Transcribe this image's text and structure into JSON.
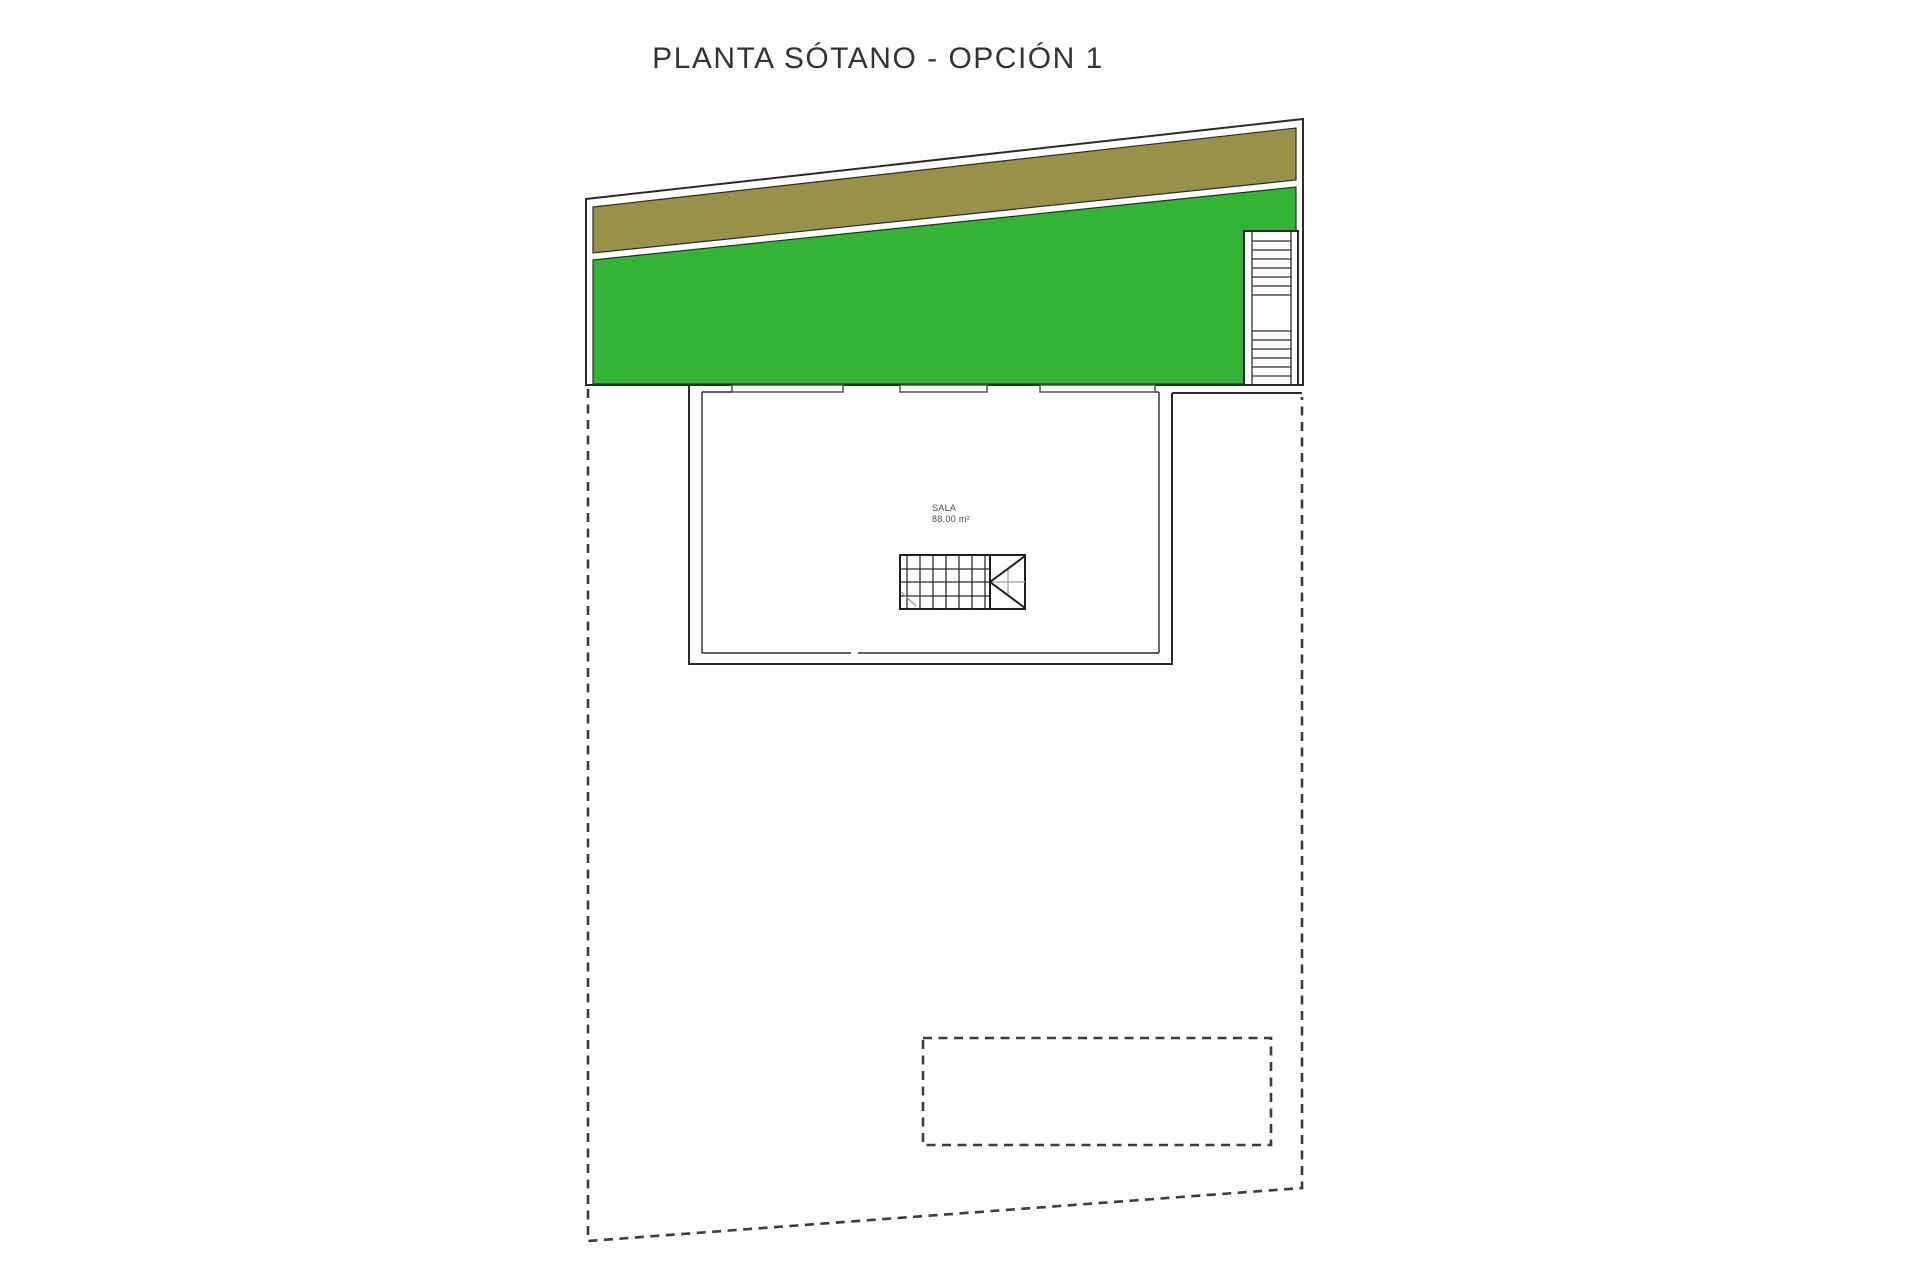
{
  "title": "PLANTA SÓTANO - OPCIÓN 1",
  "room": {
    "name": "SALA",
    "area": "88.00 m²"
  },
  "colors": {
    "grass": "#33b434",
    "soil": "#9a9149"
  }
}
